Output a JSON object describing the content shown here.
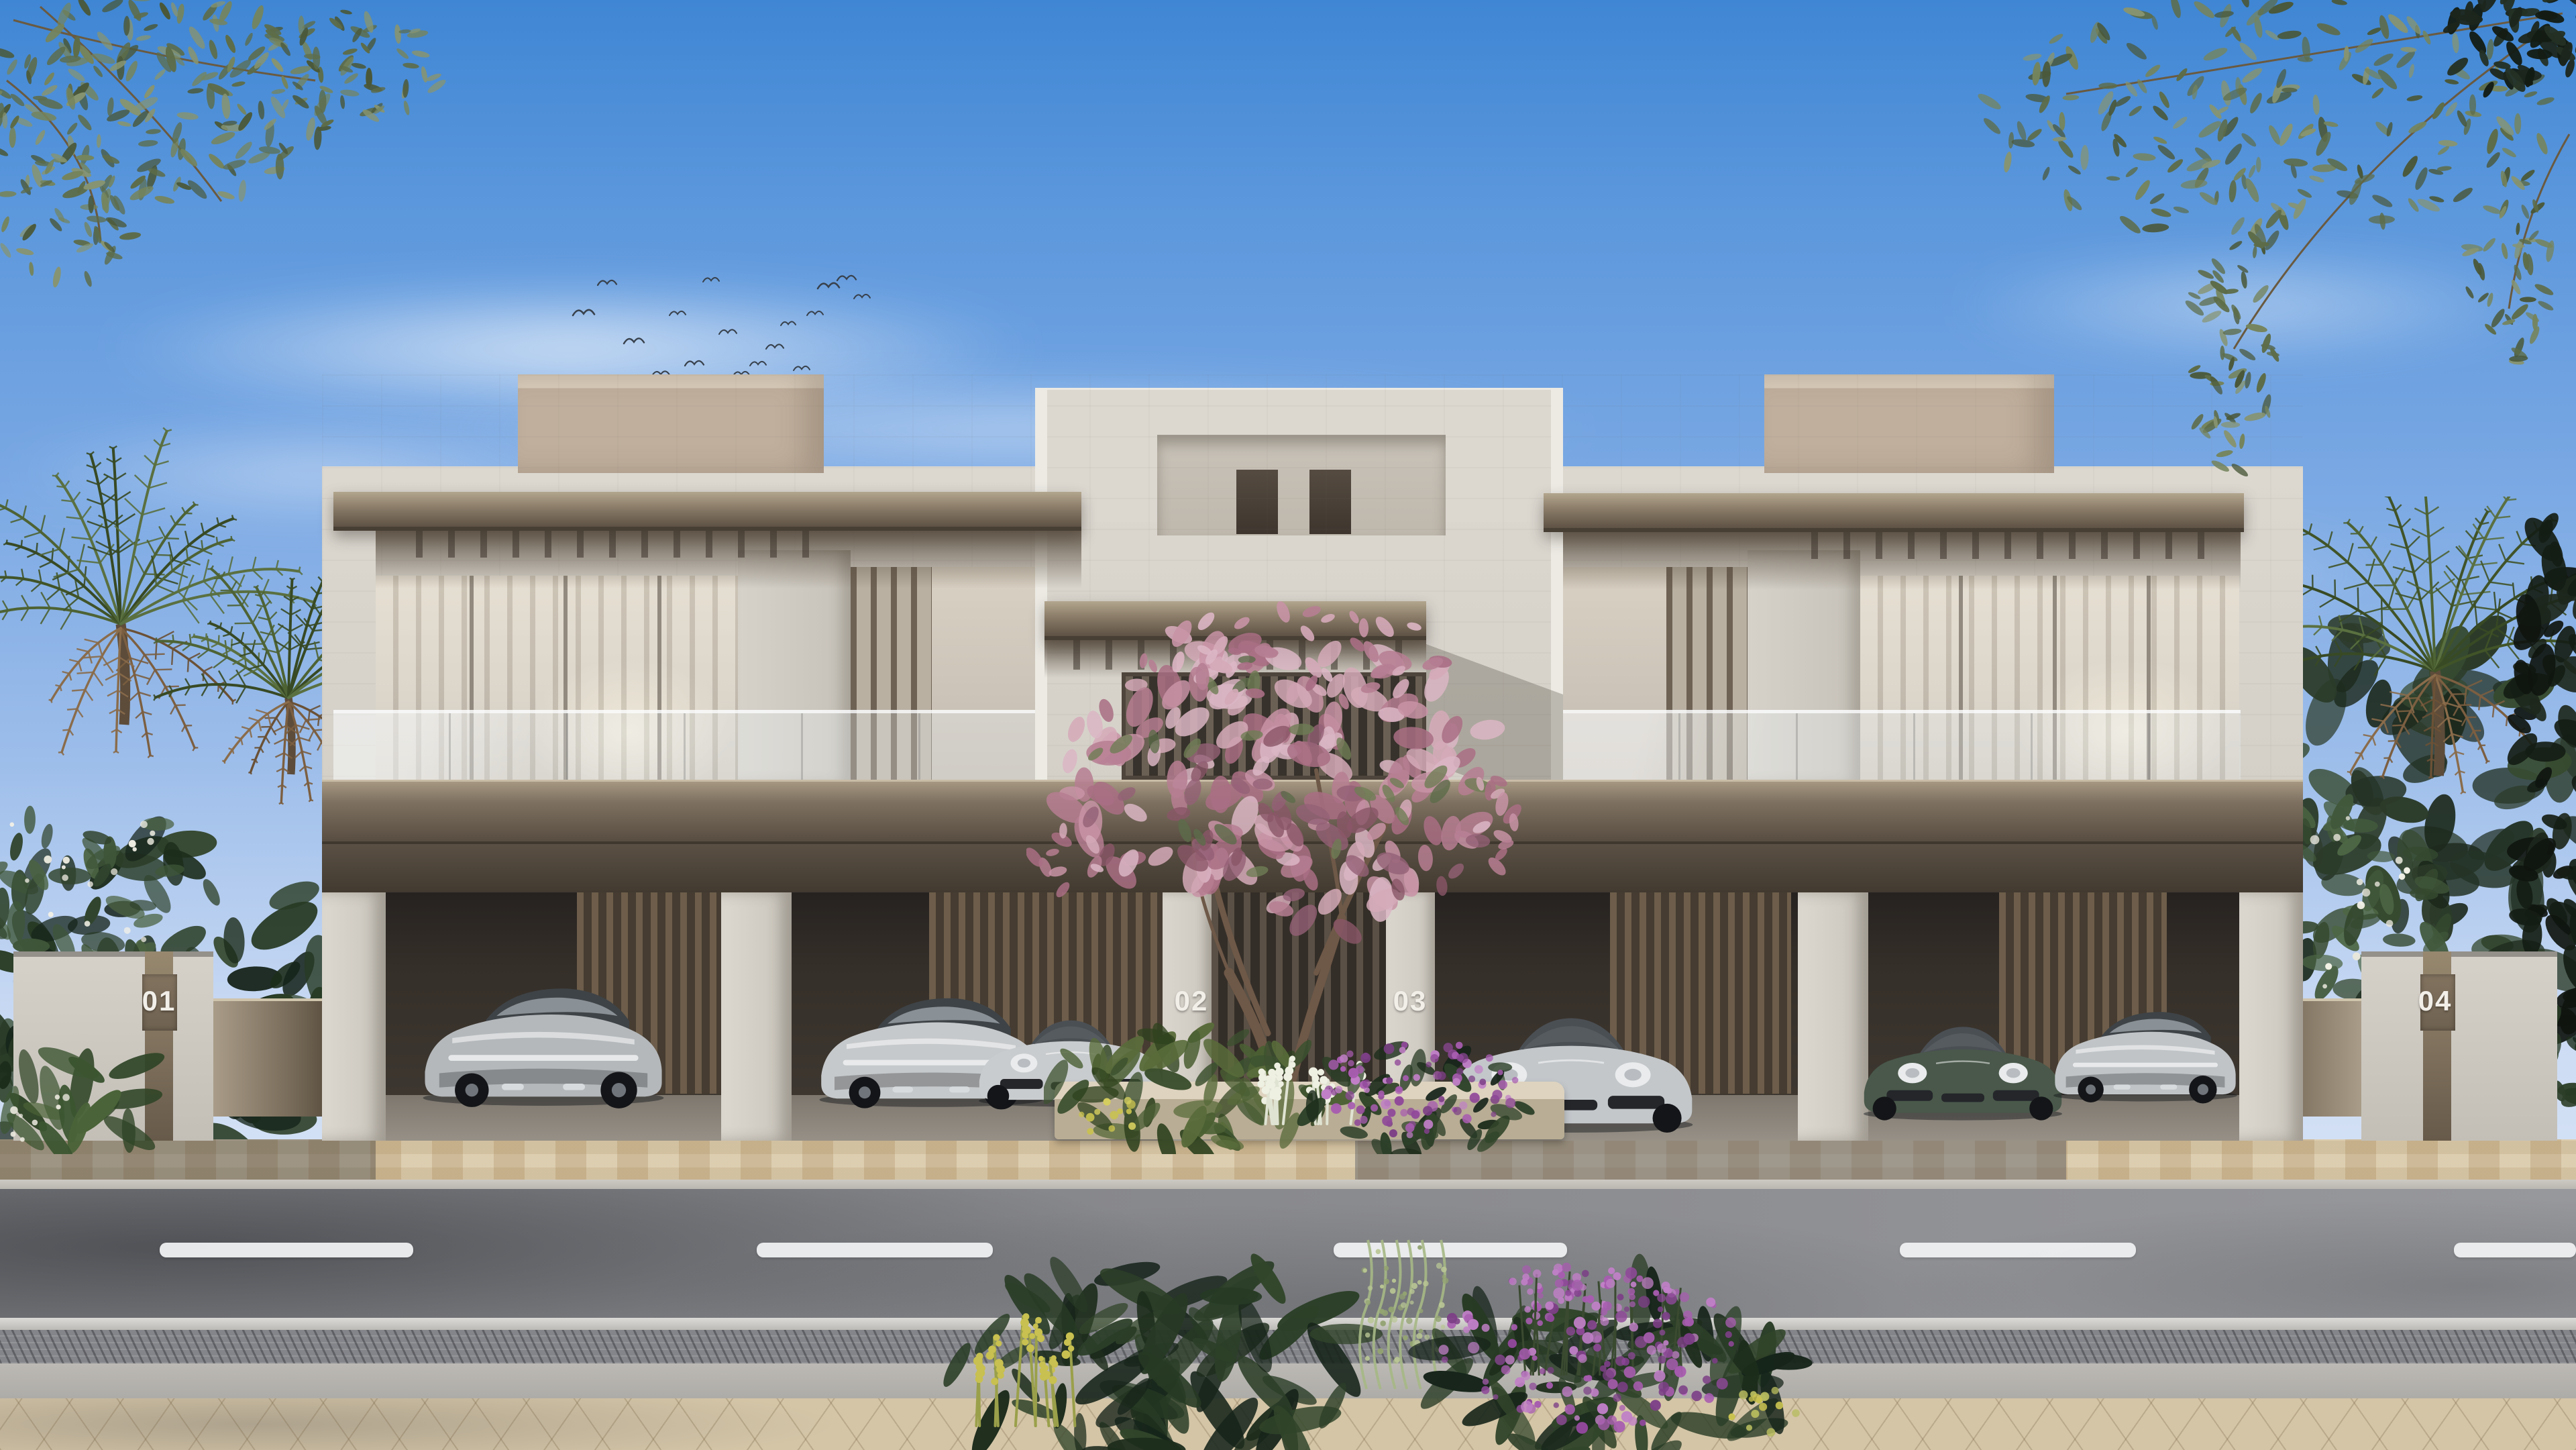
{
  "scene": {
    "description": "Photorealistic daytime architectural rendering of a row of four modern two-storey townhouse villas with travertine stone facades, bronze pergola canopies, glass balcony balustrades, vertical louver screens and ground-floor carports, seen from across a street.",
    "sky": "clear blue sky with thin white clouds and a flock of birds",
    "foreground": "asphalt road with dashed white lane markings, paved driveway, stone sidewalk and tropical planting",
    "landscape": [
      "olive branches overhanging the top corners",
      "date palms and frangipani shrubs flanking both sides",
      "pink flowering tree in the central entrance planter",
      "purple and yellow flowering plants on the front sidewalk"
    ]
  },
  "units": [
    {
      "label": "01"
    },
    {
      "label": "02"
    },
    {
      "label": "03"
    },
    {
      "label": "04"
    }
  ],
  "vehicles": [
    {
      "name": "grey sports coupe, rear view",
      "bay": "01"
    },
    {
      "name": "silver fastback coupe, rear view",
      "bay": "02"
    },
    {
      "name": "silver sports coupe, front view",
      "bay": "02"
    },
    {
      "name": "silver sports coupe, front view",
      "bay": "03"
    },
    {
      "name": "green grand tourer, front view",
      "bay": "04"
    },
    {
      "name": "silver sports coupe, rear view",
      "bay": "04"
    }
  ],
  "palette": {
    "sky_top": "#3f86d4",
    "sky_mid": "#78a7e3",
    "sky_low": "#cddcf4",
    "stone_light": "#dcd8d0",
    "stone_mid": "#cbc5bb",
    "tan_roof": "#c0af9d",
    "tan_roof_top": "#d8cbba",
    "bronze_dark": "#4c4338",
    "glass_warm": "#d8d0c2",
    "glass_cool": "#b7b0a4",
    "carport_dark": "#352f29",
    "wood_slat": "#6d5d4a",
    "paver_light": "#d8c7a6",
    "paver_grey": "#84858a",
    "road": "#88898d",
    "curb": "#bab7b1",
    "sidewalk": "#d4c5a7",
    "lane": "#eff1f2",
    "leaf_dark": "#24351f",
    "palm_green": "#4c6132",
    "palm_dry": "#7d5f41",
    "olive_leaf": "#72815a",
    "blossom_pink": "#c795a8",
    "flower_purple": "#a55cae",
    "flower_yellow": "#c8c050",
    "car_silver": "#c6c9cb",
    "car_green": "#49584a",
    "number": "#f2efe9"
  }
}
